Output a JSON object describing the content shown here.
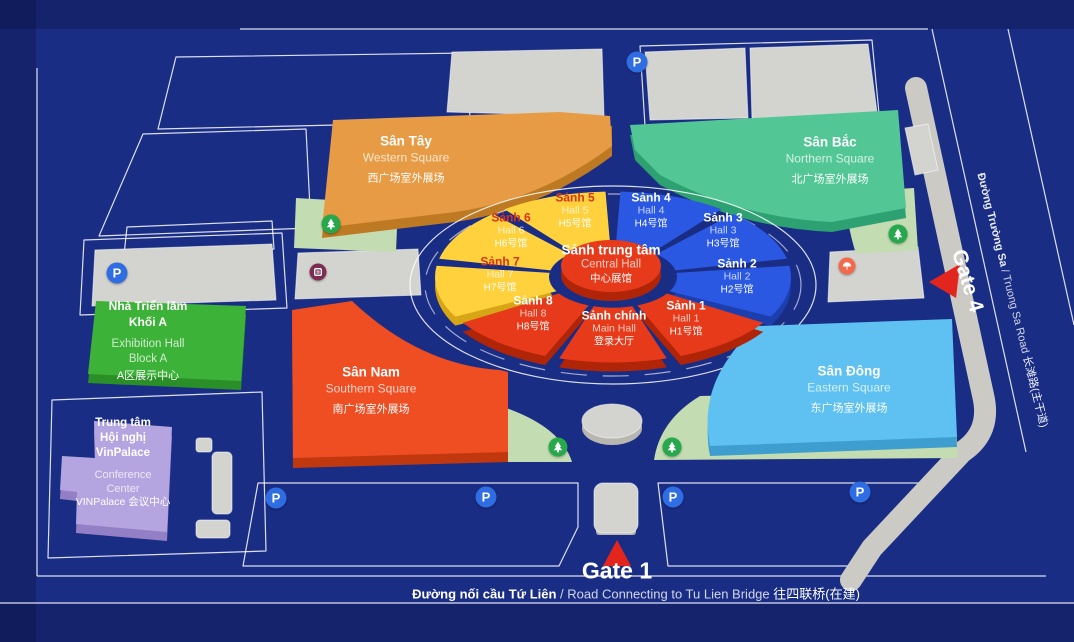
{
  "colors": {
    "background": "#1a2d85",
    "western_orange": "#e79b44",
    "western_orange_dark": "#bd7a23",
    "northern_green": "#52c795",
    "northern_green_dark": "#2da172",
    "southern_red": "#ef4d22",
    "southern_red_dark": "#c2380e",
    "eastern_blue": "#5ec1f2",
    "eastern_blue_dark": "#3e9ed0",
    "block_a_green": "#3db238",
    "block_a_green_dark": "#2b8f28",
    "vinpalace_purple": "#b4a5e0",
    "vinpalace_purple_dark": "#937fc5",
    "hall_red": "#e63a1b",
    "hall_red_dark": "#b02408",
    "hall_yellow": "#ffd13c",
    "hall_yellow_dark": "#d6a616",
    "hall_blue": "#2a58e2",
    "hall_blue_dark": "#1d3fae",
    "block_gray": "#d3d3cf",
    "block_gray_dark": "#b7b7b0",
    "road_gray": "#cbcac4",
    "pad_green": "#c3dcb2",
    "parking_blue": "#2f6de3",
    "tree_green": "#27a84c",
    "arrow_red": "#e3261d",
    "restroom_maroon": "#7b2d52",
    "emergency_orange": "#f26a4b"
  },
  "squares": {
    "western": {
      "vi": "Sân Tây",
      "en": "Western Square",
      "zh": "西广场室外展场"
    },
    "northern": {
      "vi": "Sân Bắc",
      "en": "Northern Square",
      "zh": "北广场室外展场"
    },
    "southern": {
      "vi": "Sân Nam",
      "en": "Southern Square",
      "zh": "南广场室外展场"
    },
    "eastern": {
      "vi": "Sân Đông",
      "en": "Eastern Square",
      "zh": "东广场室外展场"
    }
  },
  "central_complex": {
    "center_hall": {
      "vi": "Sảnh trung tâm",
      "en": "Central Hall",
      "zh": "中心展馆"
    },
    "halls": [
      {
        "vi": "Sảnh 1",
        "en": "Hall 1",
        "zh": "H1号馆",
        "color": "red",
        "start": 30,
        "end": 70
      },
      {
        "vi": "Sảnh 2",
        "en": "Hall 2",
        "zh": "H2号馆",
        "color": "blue",
        "start": -10,
        "end": 30
      },
      {
        "vi": "Sảnh 3",
        "en": "Hall 3",
        "zh": "H3号馆",
        "color": "blue",
        "start": 310,
        "end": 350
      },
      {
        "vi": "Sảnh 4",
        "en": "Hall 4",
        "zh": "H4号馆",
        "color": "blue",
        "start": 270,
        "end": 310
      },
      {
        "vi": "Sảnh 5",
        "en": "Hall 5",
        "zh": "H5号馆",
        "color": "yellow",
        "start": 230,
        "end": 270
      },
      {
        "vi": "Sảnh 6",
        "en": "Hall 6",
        "zh": "H6号馆",
        "color": "yellow",
        "start": 190,
        "end": 230
      },
      {
        "vi": "Sảnh 7",
        "en": "Hall 7",
        "zh": "H7号馆",
        "color": "yellow",
        "start": 150,
        "end": 190
      },
      {
        "vi": "Sảnh 8",
        "en": "Hall 8",
        "zh": "H8号馆",
        "color": "red",
        "start": 110,
        "end": 150
      },
      {
        "vi": "Sảnh chính",
        "en": "Main Hall",
        "zh": "登录大厅",
        "color": "red",
        "start": 70,
        "end": 110
      }
    ]
  },
  "buildings": {
    "exhibition_block_a": {
      "vi_lines": [
        "Nhà Triển lãm",
        "Khối A"
      ],
      "en_lines": [
        "Exhibition Hall",
        "Block A"
      ],
      "zh": "A区展示中心"
    },
    "vinpalace": {
      "vi_lines": [
        "Trung tâm",
        "Hội nghị",
        "VinPalace"
      ],
      "en_lines": [
        "Conference",
        "Center"
      ],
      "zh": "VINPalace 会议中心"
    }
  },
  "gates": {
    "gate1": "Gate 1",
    "gate4": "Gate 4"
  },
  "roads": {
    "south_road": {
      "vi": "Đường nối cầu Tứ Liên",
      "en": " / Road Connecting to Tu Lien Bridge ",
      "zh": "往四联桥(在建)"
    },
    "east_road": {
      "vi": "Đường Trường Sa",
      "en": " / Truong Sa Road ",
      "zh": "长滩路(主干道)"
    }
  },
  "icons": {
    "parking_letter": "P",
    "names": [
      "parking-icon",
      "tree-icon",
      "restroom-icon",
      "emergency-icon",
      "gate-arrow-icon"
    ]
  }
}
